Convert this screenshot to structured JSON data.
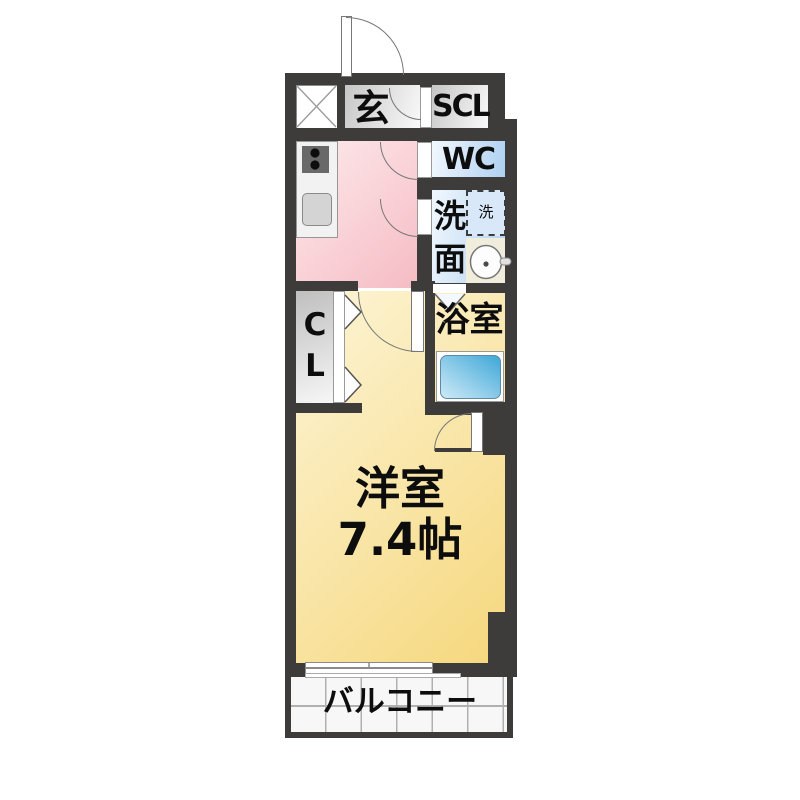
{
  "plan": {
    "genkan_label": "玄",
    "scl_label": "SCL",
    "wc_label": "WC",
    "washroom_line1": "洗",
    "washroom_line2": "面",
    "washer_label": "洗",
    "bath_label": "浴室",
    "closet_line1": "C",
    "closet_line2": "L",
    "room_label": "洋室",
    "room_size": "7.4帖",
    "balcony_label": "バルコニー"
  },
  "icons": {
    "shaft": "x-shaft-icon",
    "stove": "stove-burners-icon",
    "kitchen_sink": "kitchen-sink-icon",
    "basin": "wash-basin-icon",
    "bathtub": "bathtub-icon",
    "door_swing": "door-swing-arc",
    "folding_door": "folding-door-chevron",
    "window": "sliding-window-icon"
  },
  "colors": {
    "wall": "#3e3b3b",
    "room_yellow_light": "#fdf5d7",
    "room_yellow_dark": "#f5d77c",
    "room_pink_light": "#fdeaec",
    "room_pink_dark": "#f5bcc4",
    "room_blue_light": "#f2f8fe",
    "room_blue_dark": "#aed0f0",
    "tub_light": "#cfeaf7",
    "tub_dark": "#3fa8d8",
    "gray_room_light": "#fafafa",
    "gray_room_dark": "#c6c6c6"
  }
}
